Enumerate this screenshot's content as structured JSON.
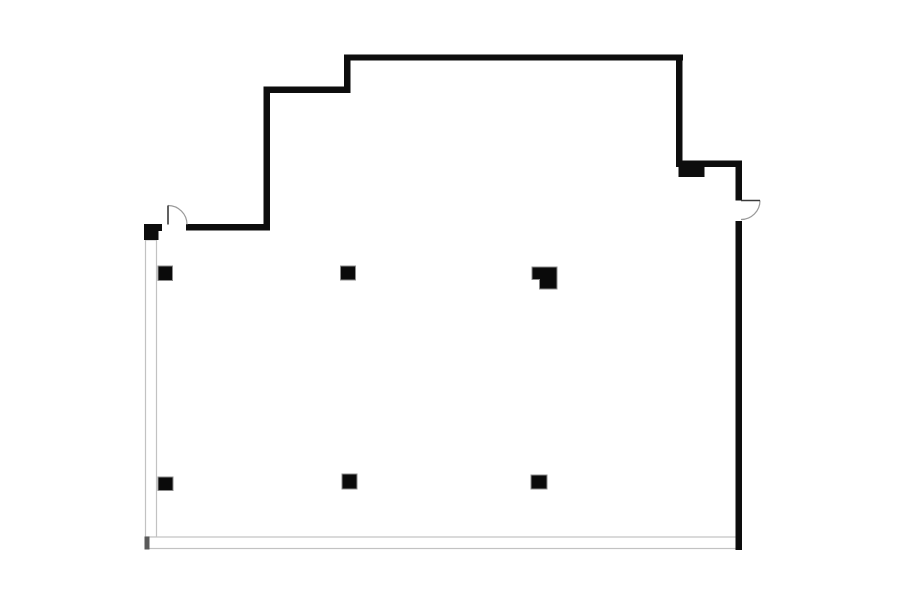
{
  "page": {
    "background": "#ffffff"
  },
  "floor_plan": {
    "canvas": {
      "width": 900,
      "height": 604
    },
    "colors": {
      "background": "#ffffff",
      "wall": "#0d0d0d",
      "thin_line": "#c2c2c2",
      "end_cap": "#5a5a5a",
      "door_leaf": "#3a3a3a",
      "door_arc": "#9a9a9a",
      "column_fill": "#0a0a0a",
      "column_stroke": "#8c8c8c"
    },
    "hollow_walls": [
      {
        "name": "left-glazed-wall",
        "x": 145.5,
        "y": 240,
        "w": 11,
        "h": 297
      },
      {
        "name": "bottom-glazed-wall",
        "x": 145.5,
        "y": 537,
        "w": 595.5,
        "h": 11.5
      }
    ],
    "end_caps": [
      {
        "name": "bottom-left-wall-cap",
        "x": 144.5,
        "y": 536.5,
        "w": 5,
        "h": 13
      }
    ],
    "solid_walls": [
      {
        "name": "top-wall",
        "x": 344,
        "y": 54.5,
        "w": 339,
        "h": 6
      },
      {
        "name": "top-step-vertical-wall",
        "x": 344,
        "y": 54.5,
        "w": 6.5,
        "h": 38.5
      },
      {
        "name": "top-step-horizontal-wall",
        "x": 263.5,
        "y": 86.5,
        "w": 87,
        "h": 6.5
      },
      {
        "name": "left-upper-vertical-wall",
        "x": 263.5,
        "y": 86.5,
        "w": 6.5,
        "h": 144
      },
      {
        "name": "entry-top-wall",
        "x": 186,
        "y": 224,
        "w": 84,
        "h": 6.5
      },
      {
        "name": "left-door-stub-wall",
        "x": 144,
        "y": 224,
        "w": 18,
        "h": 7
      },
      {
        "name": "left-corner-block",
        "x": 144,
        "y": 229,
        "w": 14.5,
        "h": 11
      },
      {
        "name": "right-upper-vertical-wall",
        "x": 676,
        "y": 54.5,
        "w": 6.5,
        "h": 112.5
      },
      {
        "name": "right-jog-wall",
        "x": 676,
        "y": 160.5,
        "w": 66,
        "h": 6.5
      },
      {
        "name": "right-wall-pilaster",
        "x": 678.5,
        "y": 167,
        "w": 26,
        "h": 10
      },
      {
        "name": "right-wall-above-door",
        "x": 735.5,
        "y": 160.5,
        "w": 6.5,
        "h": 40
      },
      {
        "name": "right-main-wall",
        "x": 735.5,
        "y": 221,
        "w": 6.5,
        "h": 329
      }
    ],
    "doors": [
      {
        "name": "left-entry-door",
        "leaf": {
          "x1": 168,
          "y1": 224.5,
          "x2": 168,
          "y2": 205.5
        },
        "arc_d": "M 168 205.5 A 19 19 0 0 1 187 224.5"
      },
      {
        "name": "right-entry-door",
        "leaf": {
          "x1": 741,
          "y1": 200.5,
          "x2": 760,
          "y2": 200.5
        },
        "arc_d": "M 760 200.5 A 19 19 0 0 1 741 219.5"
      }
    ],
    "columns": [
      {
        "name": "column-upper-left",
        "shape": "rect",
        "x": 158,
        "y": 266,
        "w": 14.5,
        "h": 14.5
      },
      {
        "name": "column-upper-middle",
        "shape": "rect",
        "x": 340.5,
        "y": 266,
        "w": 15,
        "h": 14
      },
      {
        "name": "column-upper-right",
        "shape": "polygon",
        "points": [
          [
            532,
            267
          ],
          [
            557,
            267
          ],
          [
            557,
            289
          ],
          [
            539.5,
            289
          ],
          [
            539.5,
            279.5
          ],
          [
            532,
            279.5
          ]
        ]
      },
      {
        "name": "column-lower-left",
        "shape": "rect",
        "x": 158,
        "y": 477,
        "w": 15,
        "h": 13.5
      },
      {
        "name": "column-lower-middle",
        "shape": "rect",
        "x": 342,
        "y": 474,
        "w": 15,
        "h": 15
      },
      {
        "name": "column-lower-right",
        "shape": "rect",
        "x": 531,
        "y": 475,
        "w": 16,
        "h": 14
      }
    ]
  }
}
